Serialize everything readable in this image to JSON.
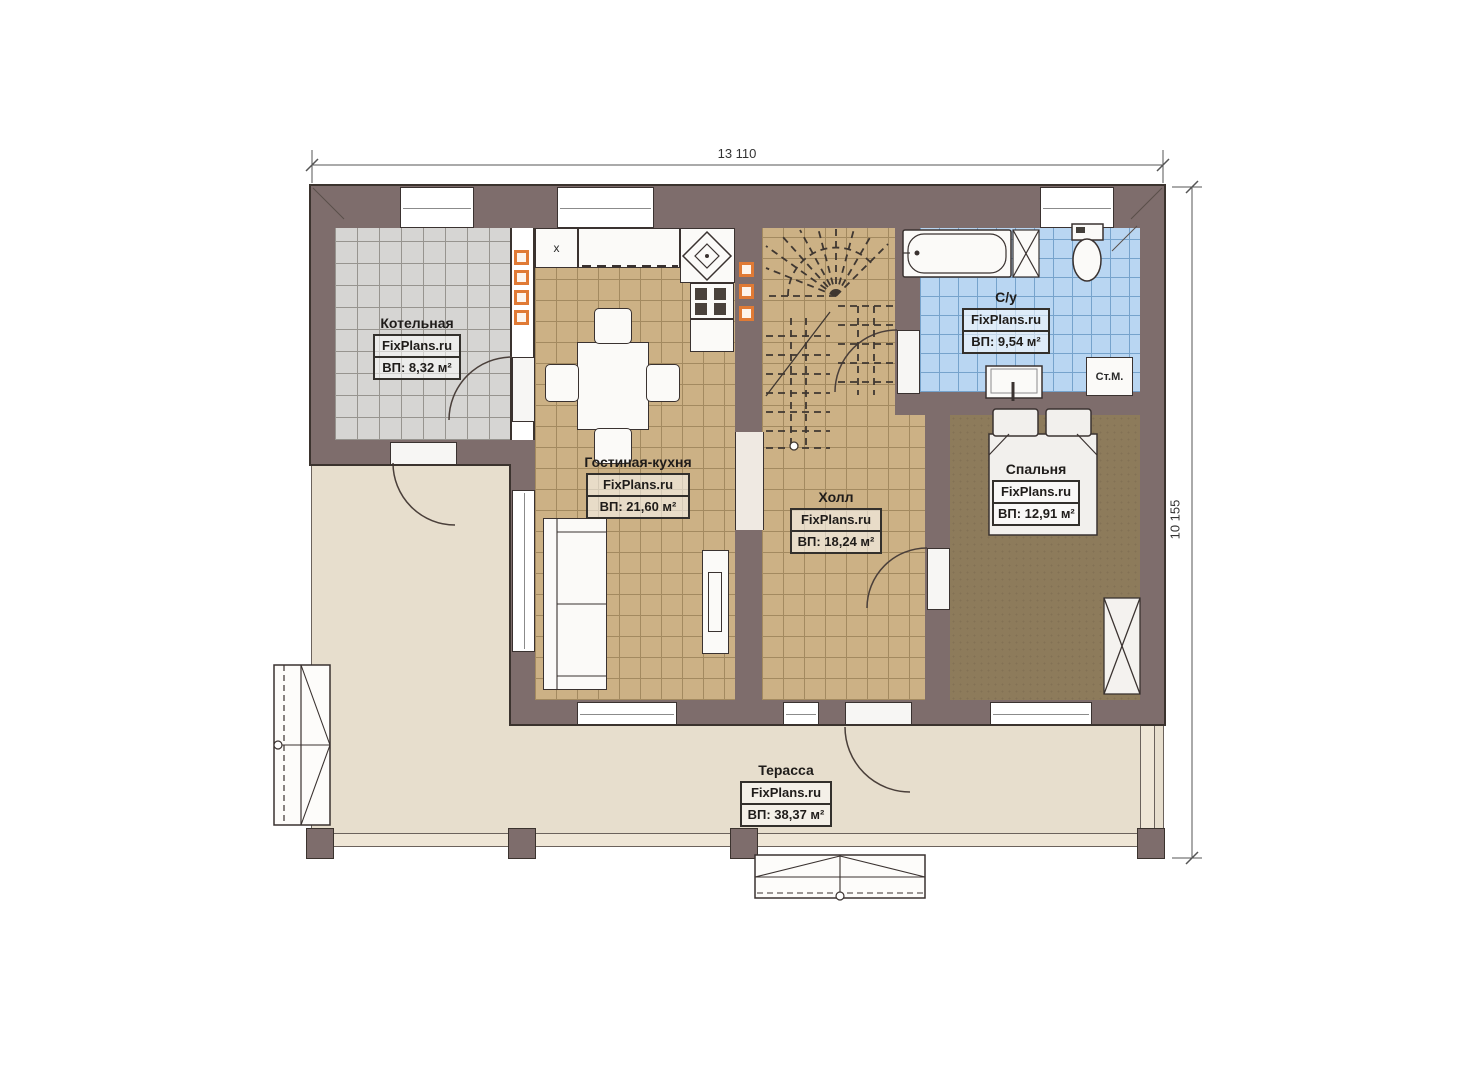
{
  "plan": {
    "brand": "FixPlans.ru",
    "dimensions": {
      "width_label": "13 110",
      "height_label": "10 155"
    },
    "rooms": [
      {
        "id": "boiler",
        "name": "Котельная",
        "area": "ВП: 8,32 м²"
      },
      {
        "id": "living",
        "name": "Гостиная-кухня",
        "area": "ВП: 21,60 м²"
      },
      {
        "id": "hall",
        "name": "Холл",
        "area": "ВП: 18,24 м²"
      },
      {
        "id": "bath",
        "name": "С/у",
        "area": "ВП: 9,54 м²"
      },
      {
        "id": "bedroom",
        "name": "Спальня",
        "area": "ВП: 12,91 м²"
      },
      {
        "id": "terrace",
        "name": "Терасса",
        "area": "ВП: 38,37 м²"
      }
    ],
    "fixtures": {
      "washing_machine": "Ст.М.",
      "fridge_mark": "x"
    },
    "colors": {
      "wall": "#7e6d6c",
      "floor_living": "#ccb185",
      "floor_boiler": "#d6d5d3",
      "floor_bath": "#b9d6f2",
      "floor_bedroom": "#8d7b5b",
      "floor_terrace": "#e7decd",
      "vent_accent": "#e07a35"
    }
  }
}
